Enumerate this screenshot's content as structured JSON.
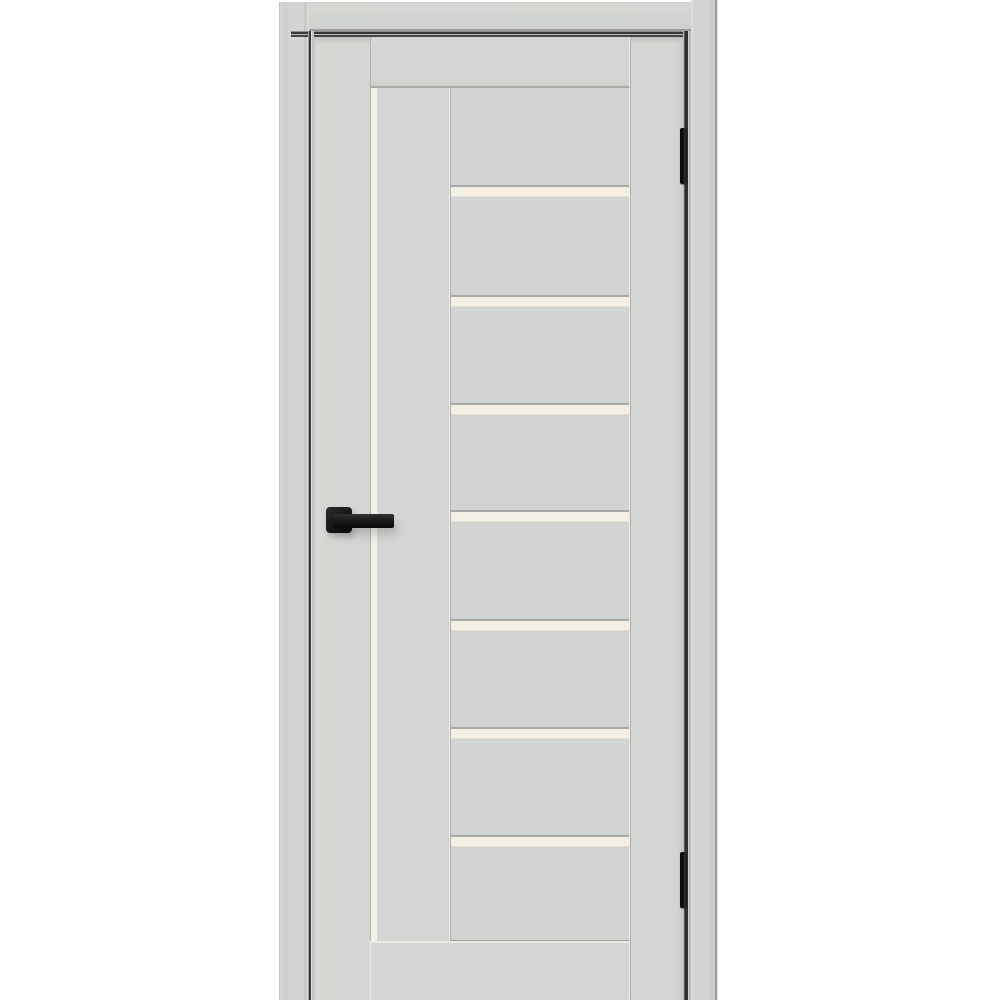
{
  "image": {
    "description": "Product photograph of a closed light-grey interior door in its frame on a white background. The door has a tall narrow frosted-glass stripe beside the left stile, a central panel column crossed by seven horizontal frosted-glass inserts, a matte-black square-rosette lever handle on the left side and two black hinges on the right edge.",
    "door_finish_name": "light grey enamel",
    "glass_name": "frosted cream glass",
    "hardware_name": "matte black"
  },
  "palette": {
    "background": "#ffffff",
    "door_face": "#d3d6d2",
    "door_face_edge": "#cfd2ce",
    "panel_face": "#d1d4d0",
    "casing_face": "#d2d5d1",
    "casing_edge_dark": "#9b9e9a",
    "glass_cream": "#f3efe4",
    "glass_edge": "#b5b2a6",
    "seam_dark": "#b0b3af",
    "seam_light": "#e8eae6",
    "strip_shadow": "#a6a9a5",
    "gap_dark": "#383838",
    "hardware_black": "#1b1b1b"
  },
  "geometry": {
    "canvas": {
      "w": 1000,
      "h": 1000
    },
    "panel_area": {
      "abs_x": 450,
      "abs_y": 88,
      "w": 180,
      "h": 853
    },
    "glass_strip_tops_y": [
      187,
      297,
      405,
      512,
      621,
      729,
      837
    ],
    "glass_strip_height": 9,
    "hinges": [
      {
        "x": 680,
        "y": 128,
        "w": 7,
        "h": 56
      },
      {
        "x": 680,
        "y": 852,
        "w": 7,
        "h": 56
      }
    ],
    "handle": {
      "rosette": {
        "x": 326,
        "y": 507,
        "w": 26,
        "h": 26
      },
      "lever": {
        "x": 333,
        "y": 514,
        "w": 61,
        "h": 14
      }
    }
  }
}
